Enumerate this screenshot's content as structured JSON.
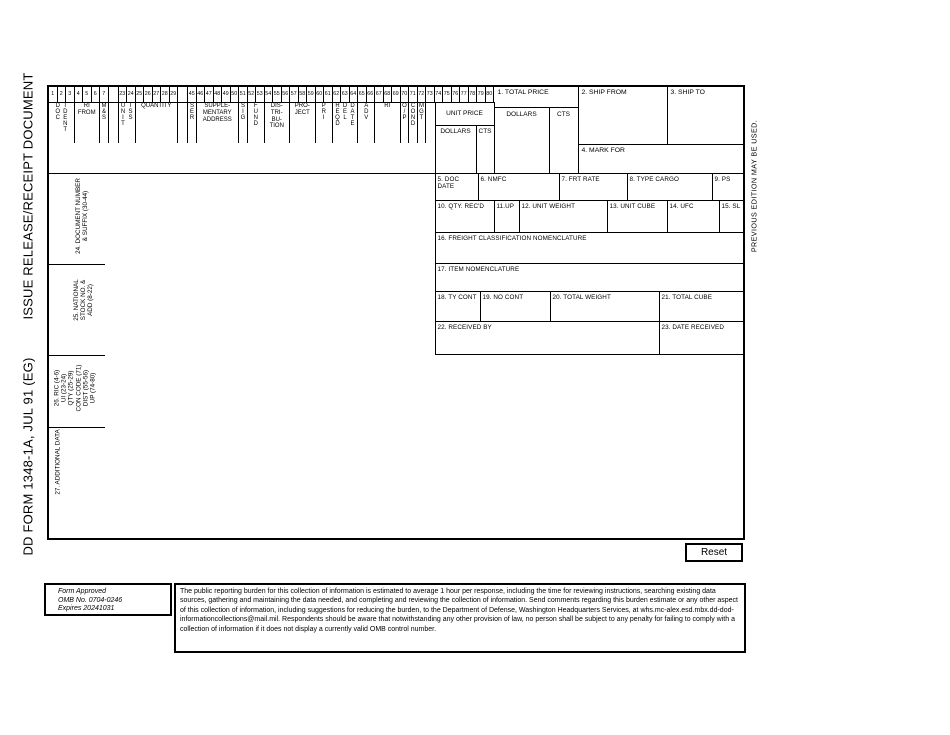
{
  "titles": {
    "form_id": "DD FORM 1348-1A, JUL 91 (EG)",
    "form_name": "ISSUE RELEASE/RECEIPT DOCUMENT",
    "edition_note": "PREVIOUS EDITION MAY BE USED."
  },
  "card_columns": {
    "numbers": [
      "1",
      "2",
      "3",
      "4",
      "5",
      "6",
      "7",
      "",
      "23",
      "24",
      "25",
      "26",
      "27",
      "28",
      "29",
      "",
      "45",
      "46",
      "47",
      "48",
      "49",
      "50",
      "51",
      "52",
      "53",
      "54",
      "55",
      "56",
      "57",
      "58",
      "59",
      "60",
      "61",
      "62",
      "63",
      "64",
      "65",
      "66",
      "67",
      "68",
      "69",
      "70",
      "71",
      "72",
      "73",
      "74",
      "75",
      "76",
      "77",
      "78",
      "79",
      "80"
    ],
    "doc_ident": [
      "DOC",
      "IDENT"
    ],
    "ri_from": [
      "RI",
      "FROM"
    ],
    "m_s": [
      "M&S"
    ],
    "unit_iss": [
      "UNIT",
      "ISS"
    ],
    "quantity": [
      "QUANTITY"
    ],
    "ser": [
      "SER"
    ],
    "supp_address": [
      "SUPPLE-",
      "MENTARY",
      "ADDRESS"
    ],
    "sig": [
      "SIG"
    ],
    "fund": [
      "FUND"
    ],
    "distribution": [
      "DIS-",
      "TRI-",
      "BU-",
      "TION"
    ],
    "project": [
      "PRO-",
      "JECT"
    ],
    "pri": [
      "PRI"
    ],
    "reqd_del_date": [
      "REQD",
      "DEL",
      "DATE"
    ],
    "adv": [
      "ADV"
    ],
    "ri": [
      "RI"
    ],
    "o_p": [
      "O/P"
    ],
    "cond": [
      "COND"
    ],
    "mgt": [
      "MGT"
    ],
    "unit_price": {
      "label": "UNIT PRICE",
      "dollars": "DOLLARS",
      "cents": "CTS"
    }
  },
  "fields": {
    "total_price": "1. TOTAL PRICE",
    "total_price_dollars": "DOLLARS",
    "total_price_cts": "CTS",
    "ship_from": "2. SHIP FROM",
    "ship_to": "3. SHIP TO",
    "mark_for": "4. MARK FOR",
    "doc_date": "5. DOC DATE",
    "nmfc": "6. NMFC",
    "frt_rate": "7. FRT RATE",
    "type_cargo": "8. TYPE CARGO",
    "ps": "9. PS",
    "qty_recd": "10. QTY. REC'D",
    "up": "11.UP",
    "unit_weight": "12. UNIT WEIGHT",
    "unit_cube": "13. UNIT CUBE",
    "ufc": "14. UFC",
    "sl": "15. SL",
    "freight_class": "16. FREIGHT CLASSIFICATION NOMENCLATURE",
    "item_nomenclature": "17. ITEM NOMENCLATURE",
    "ty_cont": "18. TY CONT",
    "no_cont": "19. NO CONT",
    "total_weight": "20. TOTAL WEIGHT",
    "total_cube": "21. TOTAL CUBE",
    "received_by": "22. RECEIVED BY",
    "date_received": "23. DATE RECEIVED"
  },
  "sections": {
    "s24": "24. DOCUMENT NUMBER\n& SUFFIX (30-44)",
    "s25": "25. NATIONAL\nSTOCK NO. &\nADD (8-22)",
    "s26": "26. RIC (4-6)\nUI (23-24)\nQTY (25-29)\nCON CODE (71)\nDIST (55-56)\nUP (74-80)",
    "s27": "27. ADDITIONAL DATA"
  },
  "footer": {
    "approval": [
      "Form Approved",
      "OMB No. 0704-0246",
      "Expires 20241031"
    ],
    "burden_statement": "The public reporting burden for this collection of information is estimated to average 1 hour per response, including the time for reviewing instructions, searching existing data sources, gathering and maintaining the data needed, and completing and reviewing the collection of information. Send comments regarding this burden estimate or any other aspect of this collection of information, including suggestions for reducing the burden, to the Department of Defense, Washington Headquarters Services, at whs.mc-alex.esd.mbx.dd-dod-informationcollections@mail.mil. Respondents should be aware that notwithstanding any other provision of law, no person shall be subject to any penalty for failing to comply with a collection of information if it does not display a currently valid OMB control number.",
    "reset_label": "Reset"
  }
}
